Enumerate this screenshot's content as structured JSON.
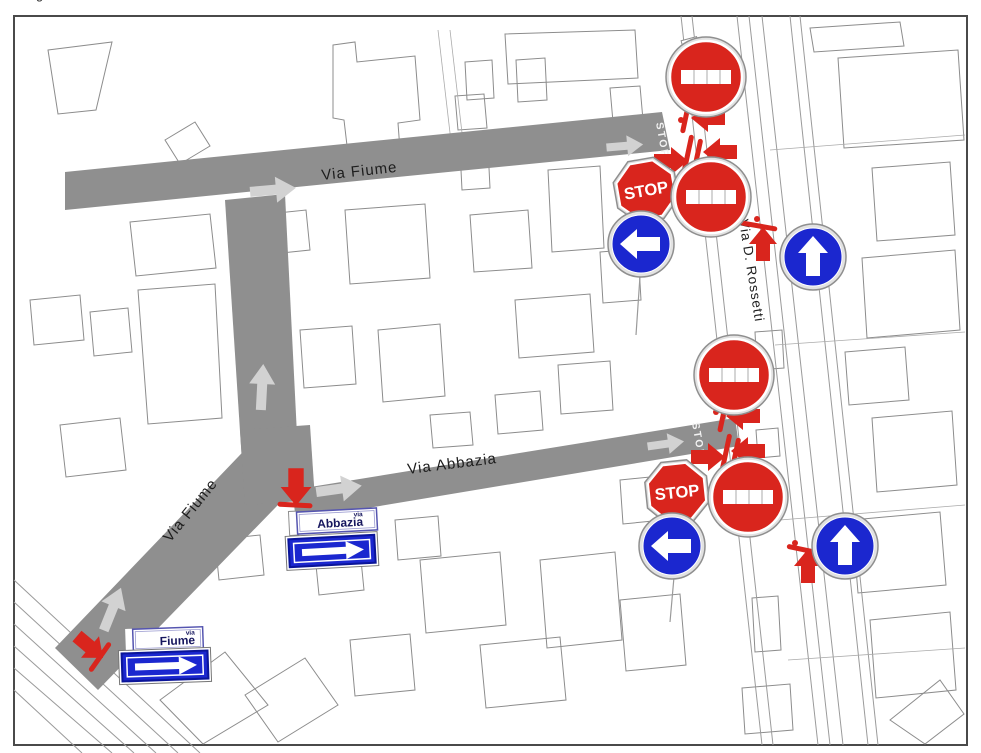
{
  "colors": {
    "frame": "#4a4a4a",
    "road": "#8f8f8f",
    "road_arrow": "#d2d2d2",
    "building_outline": "#8c8c8c",
    "sign_red": "#d9251d",
    "sign_blue": "#1b27cf",
    "plate_text": "#16165e",
    "label_text": "#1d1d1d",
    "road_marking": "#f2f2f2"
  },
  "edge_fragment": "g",
  "street_labels": {
    "via_fiume_top": "Via Fiume",
    "via_fiume_diagonal": "Via Fiume",
    "via_abbazia": "Via Abbazia",
    "via_rossetti": "Via  D.  Rossetti"
  },
  "road_markings": {
    "stop_top": "STOP",
    "stop_mid": "STOP"
  },
  "signs": {
    "stop_top_label": "STOP",
    "stop_mid_label": "STOP"
  },
  "plates": {
    "abbazia": {
      "prefix": "via",
      "name": "Abbazia"
    },
    "fiume": {
      "prefix": "via",
      "name": "Fiume"
    }
  },
  "icons": {
    "no-entry-sign-icon": "red circle with white horizontal bar (4 instances)",
    "stop-sign-icon": "red octagon with white STOP text (2 instances)",
    "mandatory-left-sign-icon": "blue circle with white left arrow (2 instances)",
    "mandatory-up-sign-icon": "blue circle with white up arrow (2 instances)",
    "one-way-panel-icon": "blue rectangle with white right arrow (2 instances)",
    "road-closure-bar-icon": "red bar across carriageway",
    "closure-arrow-icon": "solid red arrow marker",
    "traffic-flow-arrow-icon": "light gray arrow on carriageway"
  }
}
